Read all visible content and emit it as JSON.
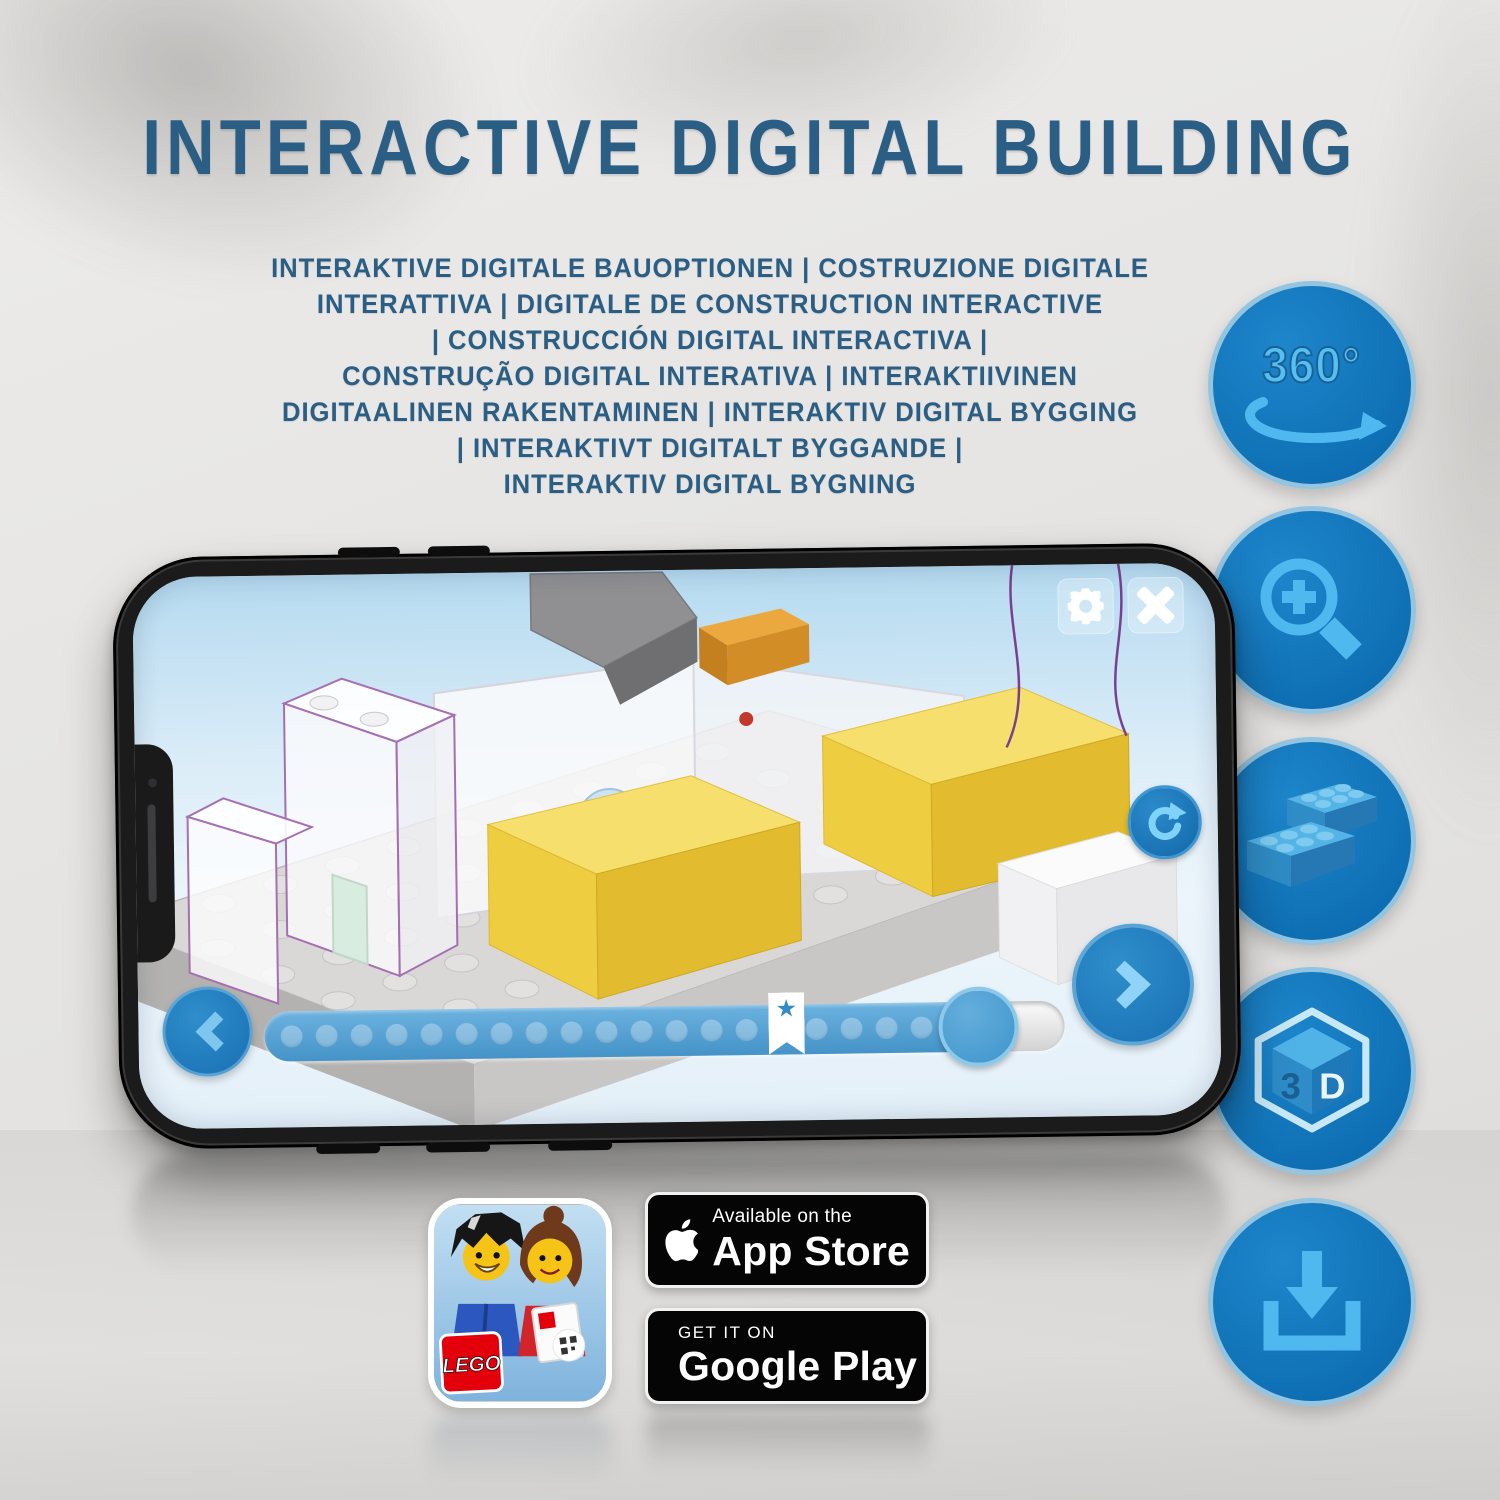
{
  "page": {
    "title": "INTERACTIVE DIGITAL BUILDING",
    "subtitle_lines": [
      "INTERAKTIVE DIGITALE BAUOPTIONEN | COSTRUZIONE DIGITALE",
      "INTERATTIVA | DIGITALE DE CONSTRUCTION INTERACTIVE",
      "| CONSTRUCCIÓN DIGITAL INTERACTIVA |",
      "CONSTRUÇÃO DIGITAL INTERATIVA | INTERAKTIIVINEN",
      "DIGITAALINEN RAKENTAMINEN | INTERAKTIV DIGITAL BYGGING",
      "| INTERAKTIVT DIGITALT BYGGANDE |",
      "INTERAKTIV DIGITAL BYGNING"
    ],
    "colors": {
      "title_blue": "#2A5E84",
      "feature_circle_blue": "#1173B9",
      "feature_icon_blue": "#4FB9EF",
      "app_button_blue": "#2E86C6",
      "brick_yellow": "#EFCD41",
      "badge_black": "#050506"
    }
  },
  "feature_icons": {
    "items": [
      {
        "name": "360-rotation-icon",
        "label": "360°"
      },
      {
        "name": "zoom-magnifier-icon"
      },
      {
        "name": "lego-bricks-icon"
      },
      {
        "name": "3d-cube-icon",
        "face_left": "3",
        "face_right": "D"
      },
      {
        "name": "download-icon"
      }
    ]
  },
  "phone": {
    "app": {
      "icons": [
        "gear",
        "close-x",
        "rotate-clockwise",
        "chevron-left",
        "chevron-right"
      ],
      "progress": {
        "dot_count": 20,
        "filled_percent": 89,
        "star_percent": 63,
        "star_glyph": "★"
      }
    }
  },
  "badges": {
    "lego_app": {
      "logo_text": "LEGO"
    },
    "app_store": {
      "tagline": "Available on the",
      "store_name": "App Store"
    },
    "google_play": {
      "tagline": "GET IT ON",
      "store_name": "Google Play"
    }
  }
}
